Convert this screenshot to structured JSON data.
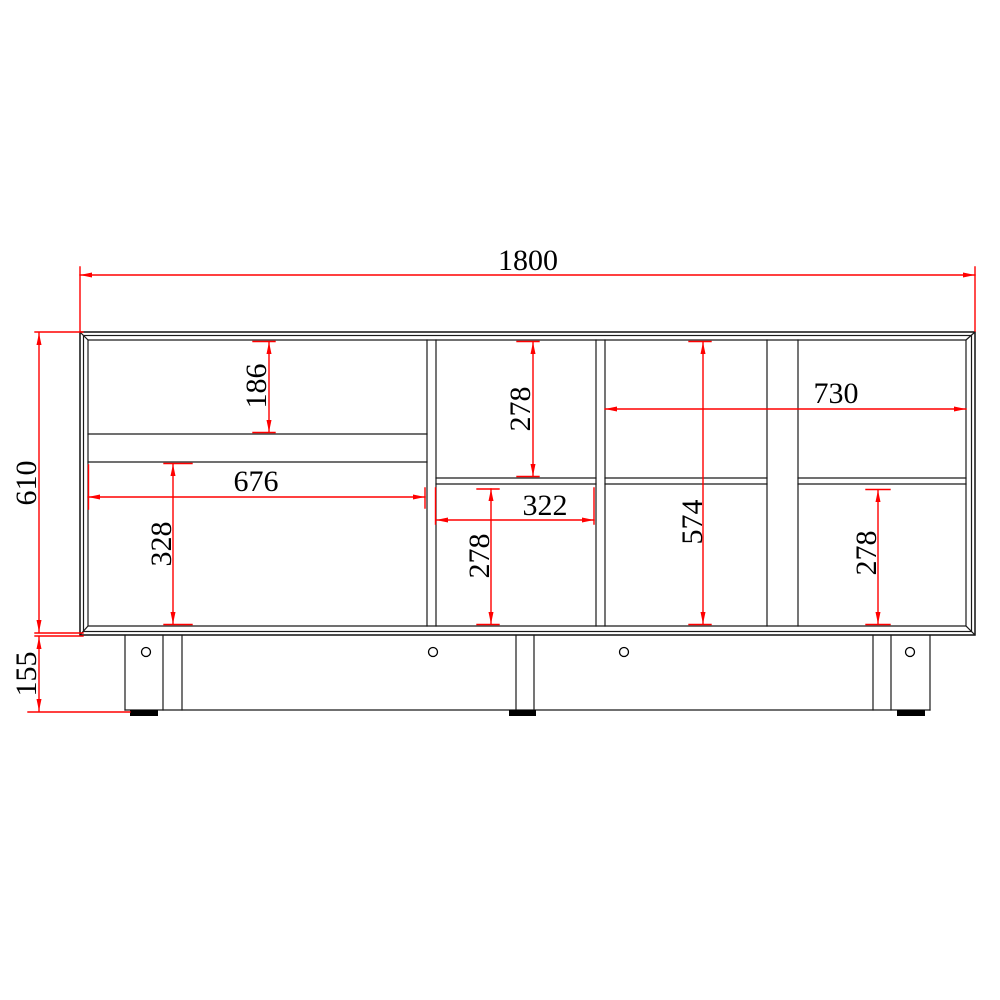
{
  "drawing": {
    "dimensions": {
      "overall_width": "1800",
      "body_height": "610",
      "base_height": "155",
      "left_upper_compartment_height": "186",
      "left_compartment_width": "676",
      "left_lower_compartment_height": "328",
      "middle_upper_compartment_height": "278",
      "middle_compartment_width": "322",
      "middle_lower_compartment_height": "278",
      "right_opening_width": "730",
      "interior_height": "574",
      "right_lower_compartment_height": "278"
    },
    "colors": {
      "dimension_lines": "#ff0000",
      "outline_lines": "#000000",
      "background": "#ffffff",
      "foot_pads": "#000000"
    }
  }
}
